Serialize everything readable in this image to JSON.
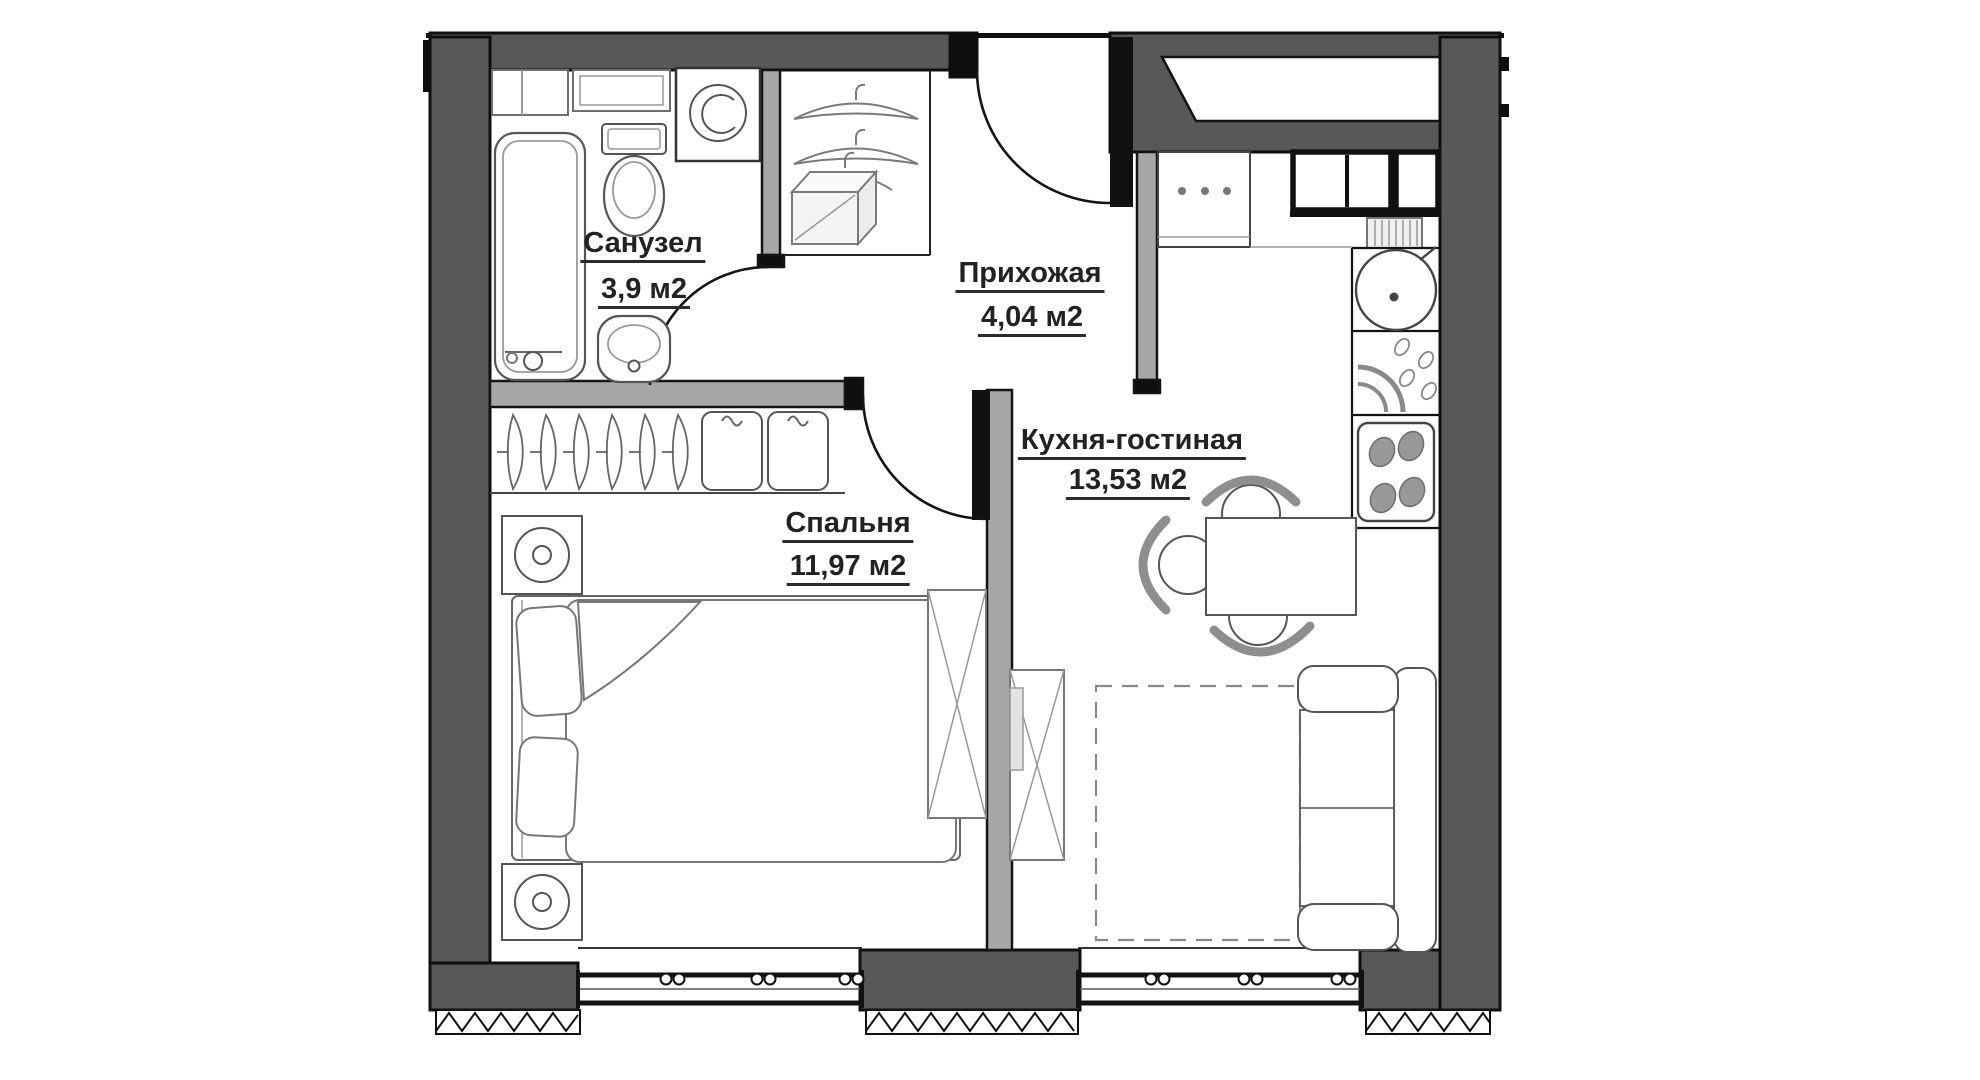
{
  "plan": {
    "rooms": [
      {
        "name": "Санузел",
        "area": "3,9 м2"
      },
      {
        "name": "Прихожая",
        "area": "4,04 м2"
      },
      {
        "name": "Спальня",
        "area": "11,97 м2"
      },
      {
        "name": "Кухня-гостиная",
        "area": "13,53 м2"
      }
    ],
    "colors": {
      "wall_dark": "#57585a",
      "wall_light": "#a7a7a9",
      "outline": "#0f0f0f",
      "furniture_stroke": "#6f6f6f",
      "text": "#222222",
      "background": "#ffffff"
    }
  }
}
